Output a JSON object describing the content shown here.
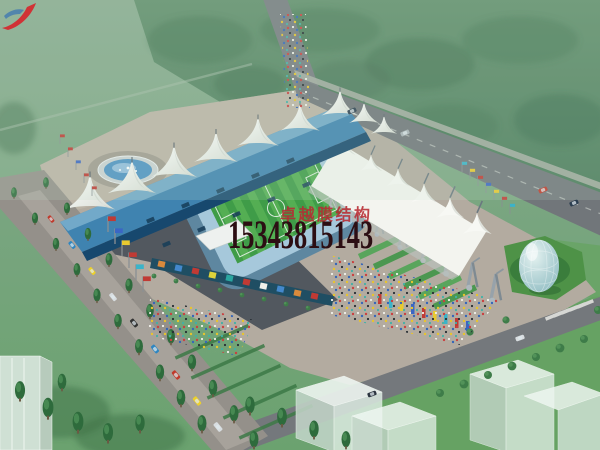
{
  "watermark": {
    "company_name": "卓越膜结构",
    "phone_number": "15343815143",
    "logo": "red-swoosh-bird-logo"
  },
  "colors": {
    "lawn": "#7fa886",
    "forest": "#4f7f5d",
    "vivid_lawn": "#66a263",
    "road": "#71767a",
    "avenue": "#94908a",
    "plaza": "#b3aba0",
    "shadow": "#3d4651",
    "roof_blue": "#3f83b0",
    "roof_eave": "#17486e",
    "membrane_white": "#f3f4ef",
    "pitch_green": "#3f9c48",
    "pitch_stripe": "#54ae53",
    "seat_blue": "#a6c8db",
    "bowl_teal": "#5e87a0",
    "water_blue": "#4f93c4",
    "dome_glass": "#aacfd2",
    "banner_teal": "#1f4e63",
    "watermark_red": "#c13038",
    "phone_color": "#2c0e13"
  }
}
